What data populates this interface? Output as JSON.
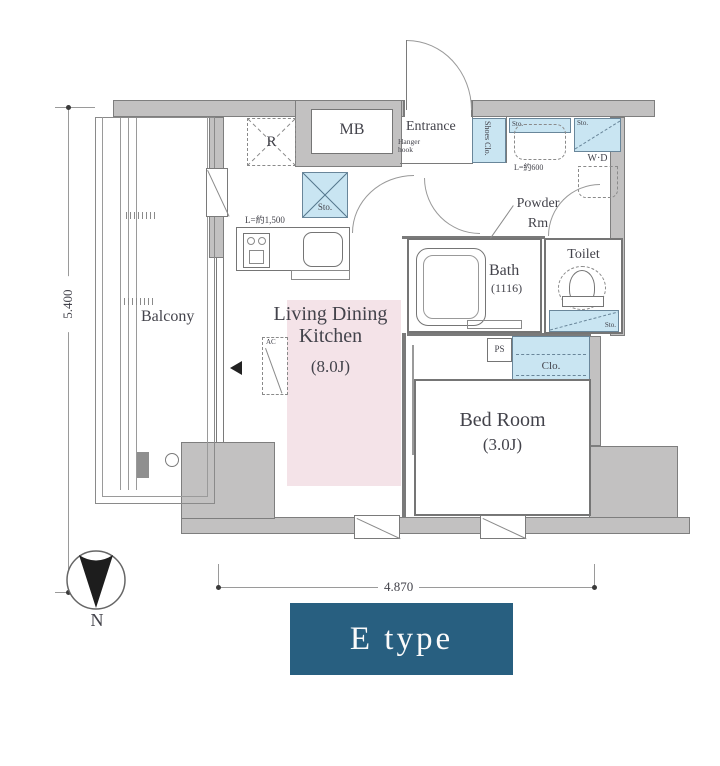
{
  "title": "Floor plan E type",
  "labels": {
    "mb": "MB",
    "r": "R",
    "entrance": "Entrance",
    "hanger_hook": "Hanger hook",
    "shoes_clo": "Shoes Clo.",
    "sto": "Sto.",
    "wd": "W·D",
    "sink_dim": "L=約600",
    "kitchen_dim": "L=約1,500",
    "powder_line1": "Powder",
    "powder_line2": "Rm",
    "bath": "Bath",
    "bath_size": "(1116)",
    "toilet": "Toilet",
    "ps": "PS",
    "clo": "Clo.",
    "ac": "AC",
    "ldk_line1": "Living Dining",
    "ldk_line2": "Kitchen",
    "ldk_size": "(8.0J)",
    "bedroom": "Bed Room",
    "bedroom_size": "(3.0J)",
    "balcony": "Balcony"
  },
  "dimensions": {
    "height": "5.400",
    "width": "4.870"
  },
  "compass": {
    "north": "N"
  },
  "plan_type": {
    "label": "E type"
  },
  "colors": {
    "wall_gray": "#c2c1c1",
    "storage_blue": "#c9e5f2",
    "ldk_pink": "#f4e3e8",
    "type_box": "#285f80",
    "line": "#7a7a7a"
  }
}
